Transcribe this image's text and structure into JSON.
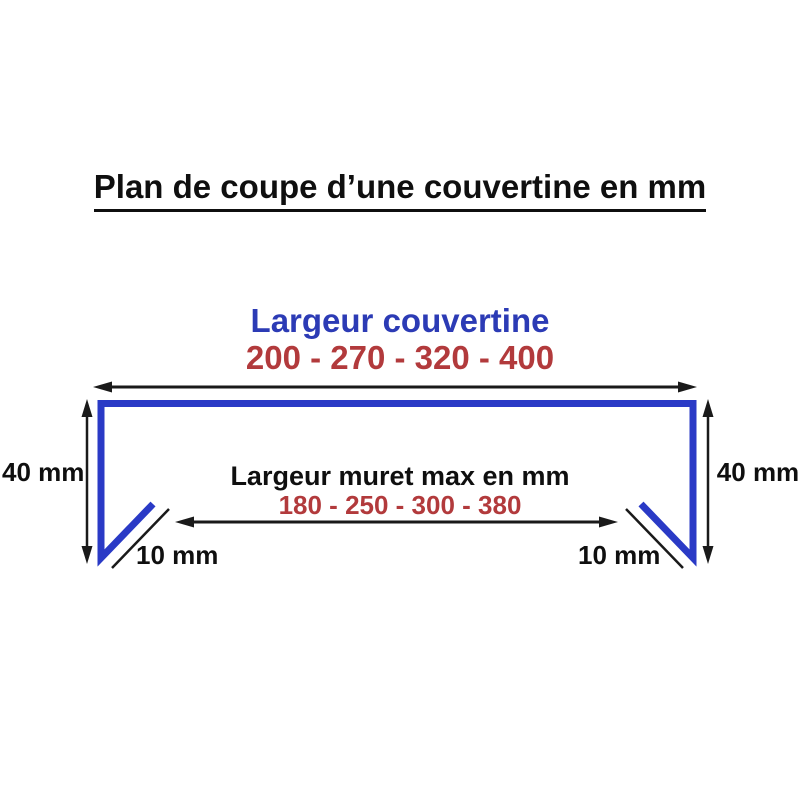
{
  "diagram": {
    "title": "Plan de coupe d’une couvertine en mm",
    "couvertine": {
      "label": "Largeur couvertine",
      "values_display": "200 - 270 - 320 - 400",
      "values": [
        200,
        270,
        320,
        400
      ]
    },
    "muret": {
      "label": "Largeur muret max en mm",
      "values_display": "180 - 250 - 300 - 380",
      "values": [
        180,
        250,
        300,
        380
      ]
    },
    "height_dim": {
      "label": "40 mm"
    },
    "drip_dim": {
      "label": "10 mm"
    },
    "colors": {
      "profile_blue": "#2a3ac6",
      "label_blue": "#2c3bb5",
      "value_red": "#b23a3c",
      "line_black": "#1a1a1a",
      "background": "#ffffff"
    }
  }
}
